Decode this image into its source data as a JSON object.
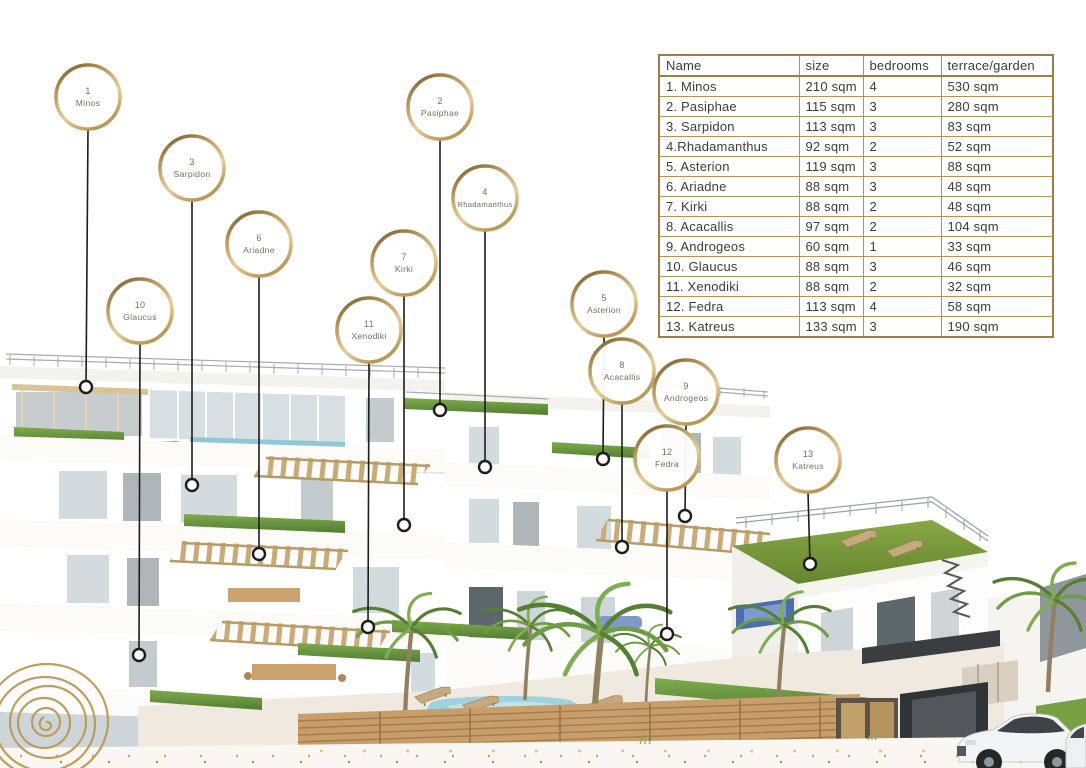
{
  "branding": {
    "logo": "spiral-labyrinth-logo"
  },
  "colors": {
    "gold": "#b6965a",
    "gold_dark": "#6e5627",
    "gold_light": "#e3cf9c",
    "leader_line": "#1d1d1b",
    "table_border": "#9d7e46",
    "table_text": "#3c3c3c",
    "marker_text": "#757067",
    "grass": "#6e9540",
    "pool": "#9fd2dd",
    "wood_fence": "#c89e6b"
  },
  "table": {
    "columns": [
      "Name",
      "size",
      "bedrooms",
      "terrace/garden"
    ],
    "rows": [
      [
        "1. Minos",
        "210 sqm",
        "4",
        "530 sqm"
      ],
      [
        "2. Pasiphae",
        "115 sqm",
        "3",
        "280 sqm"
      ],
      [
        "3. Sarpidon",
        "113 sqm",
        "3",
        "83 sqm"
      ],
      [
        "4.Rhadamanthus",
        "92 sqm",
        "2",
        "52 sqm"
      ],
      [
        "5. Asterion",
        "119 sqm",
        "3",
        "88 sqm"
      ],
      [
        "6. Ariadne",
        "88 sqm",
        "3",
        "48 sqm"
      ],
      [
        "7. Kirki",
        "88 sqm",
        "2",
        "48 sqm"
      ],
      [
        "8. Acacallis",
        "97 sqm",
        "2",
        "104 sqm"
      ],
      [
        "9. Androgeos",
        "60 sqm",
        "1",
        "33 sqm"
      ],
      [
        "10. Glaucus",
        "88 sqm",
        "3",
        "46 sqm"
      ],
      [
        "11. Xenodiki",
        "88 sqm",
        "2",
        "32 sqm"
      ],
      [
        "12. Fedra",
        "113 sqm",
        "4",
        "58 sqm"
      ],
      [
        "13. Katreus",
        "133 sqm",
        "3",
        "190 sqm"
      ]
    ]
  },
  "markers": [
    {
      "number": "1",
      "name": "Minos",
      "cx": 88,
      "cy": 97,
      "ex": 86,
      "ey": 387
    },
    {
      "number": "2",
      "name": "Pasiphae",
      "cx": 440,
      "cy": 107,
      "ex": 440,
      "ey": 410
    },
    {
      "number": "3",
      "name": "Sarpidon",
      "cx": 192,
      "cy": 168,
      "ex": 192,
      "ey": 485
    },
    {
      "number": "4",
      "name": "Rhadamanthus",
      "cx": 485,
      "cy": 198,
      "ex": 485,
      "ey": 467
    },
    {
      "number": "5",
      "name": "Asterion",
      "cx": 604,
      "cy": 304,
      "ex": 603,
      "ey": 459
    },
    {
      "number": "6",
      "name": "Ariadne",
      "cx": 259,
      "cy": 244,
      "ex": 259,
      "ey": 554
    },
    {
      "number": "7",
      "name": "Kirki",
      "cx": 404,
      "cy": 263,
      "ex": 404,
      "ey": 525
    },
    {
      "number": "8",
      "name": "Acacallis",
      "cx": 622,
      "cy": 371,
      "ex": 622,
      "ey": 547
    },
    {
      "number": "9",
      "name": "Androgeos",
      "cx": 686,
      "cy": 392,
      "ex": 685,
      "ey": 516
    },
    {
      "number": "10",
      "name": "Glaucus",
      "cx": 140,
      "cy": 311,
      "ex": 139,
      "ey": 655
    },
    {
      "number": "11",
      "name": "Xenodiki",
      "cx": 369,
      "cy": 330,
      "ex": 368,
      "ey": 627
    },
    {
      "number": "12",
      "name": "Fedra",
      "cx": 667,
      "cy": 458,
      "ex": 667,
      "ey": 634
    },
    {
      "number": "13",
      "name": "Katreus",
      "cx": 808,
      "cy": 460,
      "ex": 810,
      "ey": 564
    }
  ]
}
